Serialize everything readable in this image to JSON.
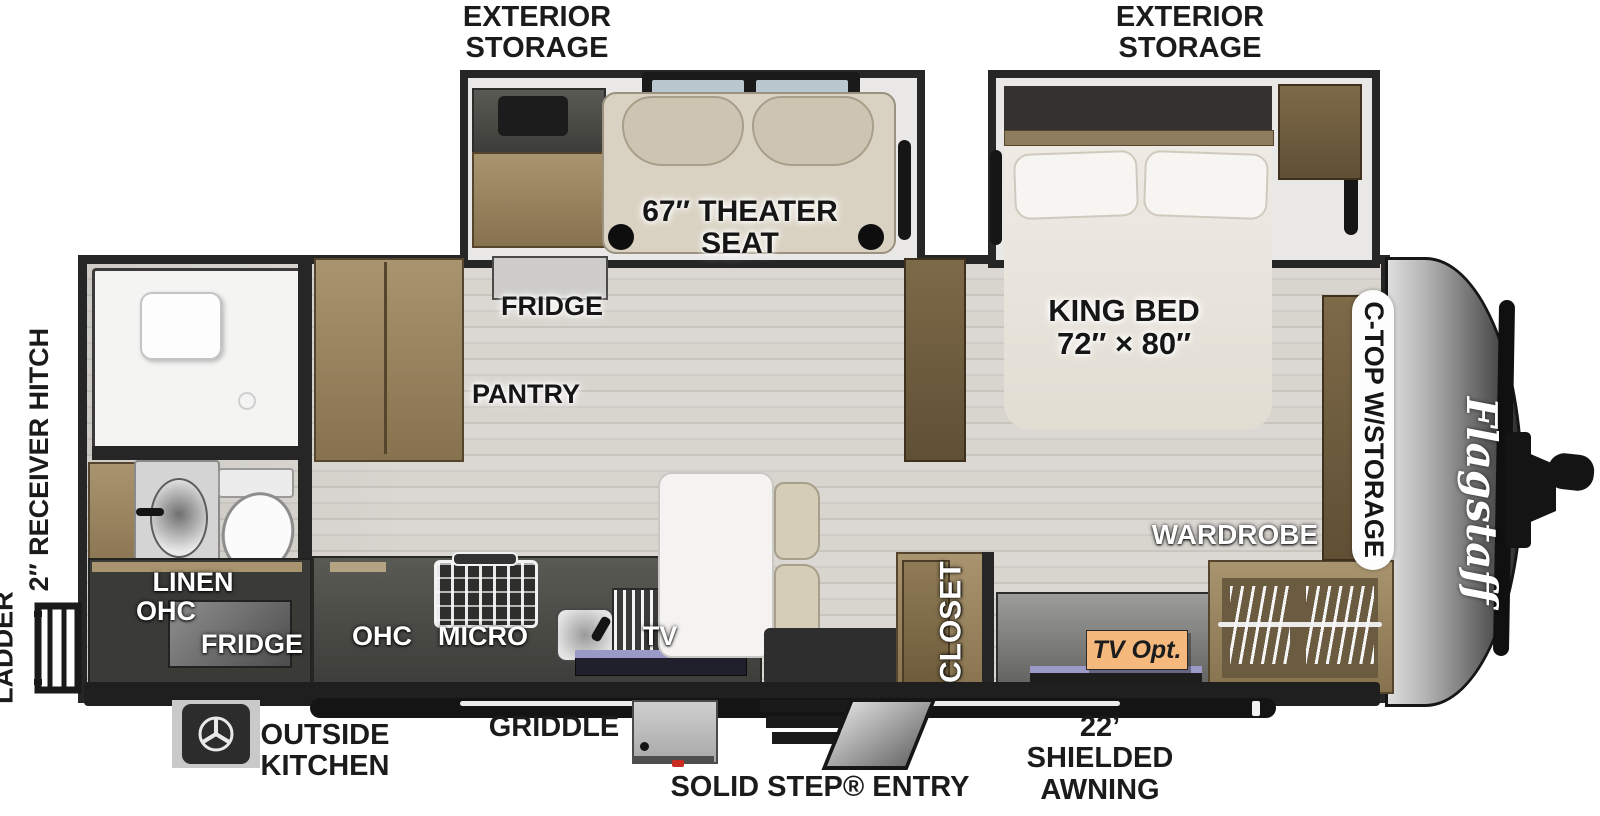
{
  "plan": {
    "brand_logo": "Flagstaff",
    "exterior_storage": {
      "line1": "EXTERIOR",
      "line2": "STORAGE"
    },
    "receiver_hitch": "2″ RECEIVER HITCH",
    "ladder": "LADDER",
    "outside_kitchen": {
      "line1": "OUTSIDE",
      "line2": "KITCHEN"
    },
    "griddle": "GRIDDLE",
    "solid_step": "SOLID STEP® ENTRY",
    "awning": {
      "line1": "22’ SHIELDED",
      "line2": "AWNING"
    },
    "theater_seat": {
      "line1": "67″ THEATER",
      "line2": "SEAT"
    },
    "king_bed": {
      "line1": "KING BED",
      "line2": "72″ × 80″"
    },
    "fridge": "FRIDGE",
    "pantry": "PANTRY",
    "ohc": "OHC",
    "micro": "MICRO",
    "tv": "TV",
    "linen_ohc": {
      "line1": "LINEN",
      "line2": "OHC"
    },
    "rear_fridge": "FRIDGE",
    "closet": "CLOSET",
    "wardrobe": "WARDROBE",
    "ctop": "C-TOP W/STORAGE",
    "tv_opt": "TV Opt."
  },
  "colors": {
    "outline": "#262626",
    "floor": "#d8d5cf",
    "wood": "#97835f",
    "upholstery": "#d9d2c2",
    "tv_opt_badge": "#f5b97e",
    "frame": "#1f1f1f",
    "glass": "#b9c7cf"
  }
}
